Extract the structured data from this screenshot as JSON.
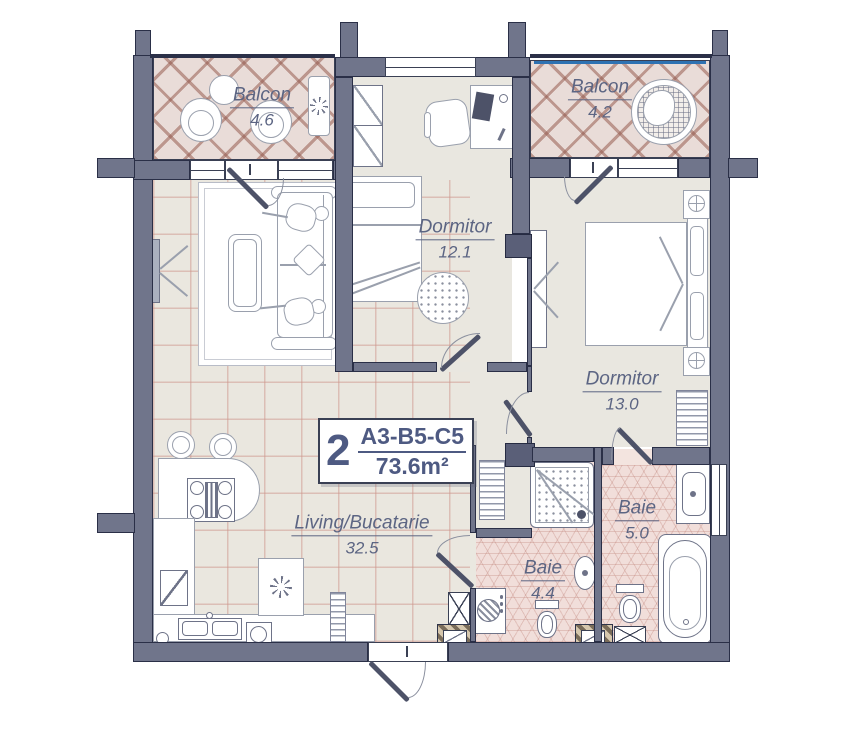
{
  "unit": {
    "number": "2",
    "code": "A3-B5-C5",
    "area": "73.6m²"
  },
  "rooms": [
    {
      "key": "balcony-left",
      "name": "Balcon",
      "area": "4.6"
    },
    {
      "key": "balcony-right",
      "name": "Balcon",
      "area": "4.2"
    },
    {
      "key": "bedroom-top",
      "name": "Dormitor",
      "area": "12.1"
    },
    {
      "key": "bedroom-right",
      "name": "Dormitor",
      "area": "13.0"
    },
    {
      "key": "living-kitchen",
      "name": "Living/Bucatarie",
      "area": "32.5"
    },
    {
      "key": "bath-small",
      "name": "Baie",
      "area": "4.4"
    },
    {
      "key": "bath-large",
      "name": "Baie",
      "area": "5.0"
    }
  ],
  "colors": {
    "wall": "#70758b",
    "wall_outline": "#2a2f47",
    "floor": "#e9e7e0",
    "balcony_lattice": "#a6766c",
    "living_grid": "#dcbcb4",
    "bath_tile": "#f1deda",
    "label_text": "#5c6583",
    "unit_text": "#4e5a82",
    "railing_blue": "#2e72b2",
    "door_leaf": "#4d5268"
  }
}
